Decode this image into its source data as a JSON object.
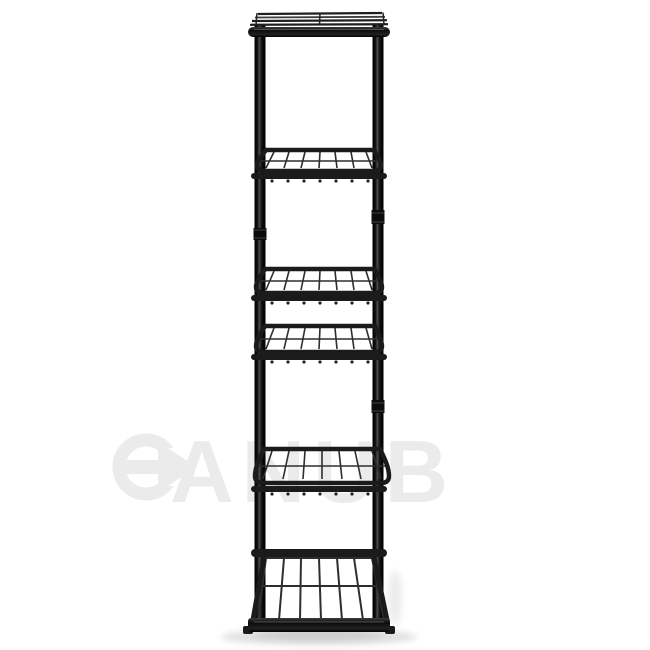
{
  "scene": {
    "description": "Tall narrow black metal six-tier flower pot stand with wire shelves, photographed on a plain white studio background with a soft floor shadow",
    "background_color": "#ffffff",
    "frame_color": "#1b1b1b",
    "wire_color": "#2e2e2e",
    "shadow_color": "#d8d8d8",
    "tier_count": 6
  },
  "watermark": {
    "full_text": "DANUB",
    "letters_after_logo": "ANUB",
    "logo_icon": "arrow-d",
    "color": "#ebebeb"
  }
}
